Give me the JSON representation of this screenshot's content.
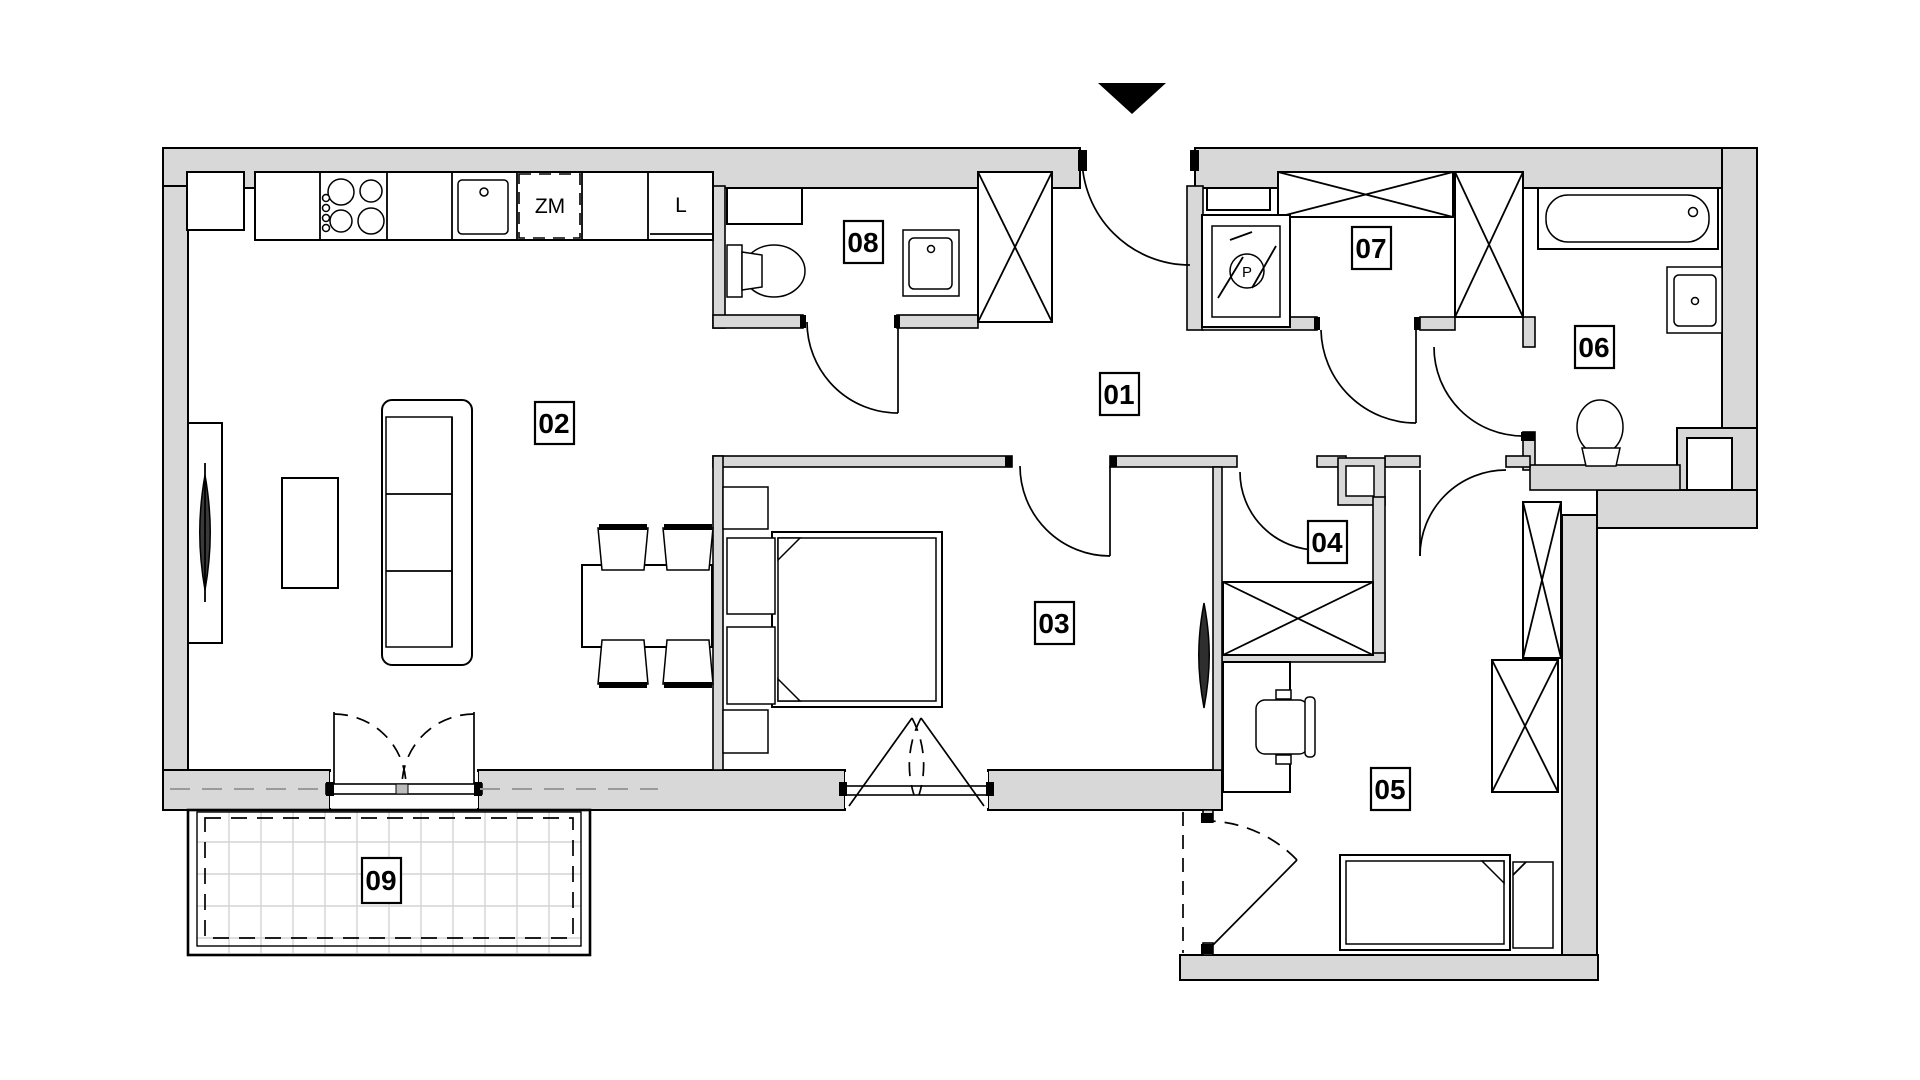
{
  "title": "apartment-floor-plan",
  "colors": {
    "wall_fill": "#d8d8d8",
    "outline": "#000000",
    "tile_grid": "#d4d4d4",
    "page_bg": "#ffffff"
  },
  "rooms": [
    {
      "id": "room-01",
      "label": "01"
    },
    {
      "id": "room-02",
      "label": "02"
    },
    {
      "id": "room-03",
      "label": "03"
    },
    {
      "id": "room-04",
      "label": "04"
    },
    {
      "id": "room-05",
      "label": "05"
    },
    {
      "id": "room-06",
      "label": "06"
    },
    {
      "id": "room-07",
      "label": "07"
    },
    {
      "id": "room-08",
      "label": "08"
    },
    {
      "id": "room-09",
      "label": "09"
    }
  ],
  "annotations": {
    "dishwasher": "ZM",
    "fridge": "L",
    "washing_machine": "P"
  }
}
